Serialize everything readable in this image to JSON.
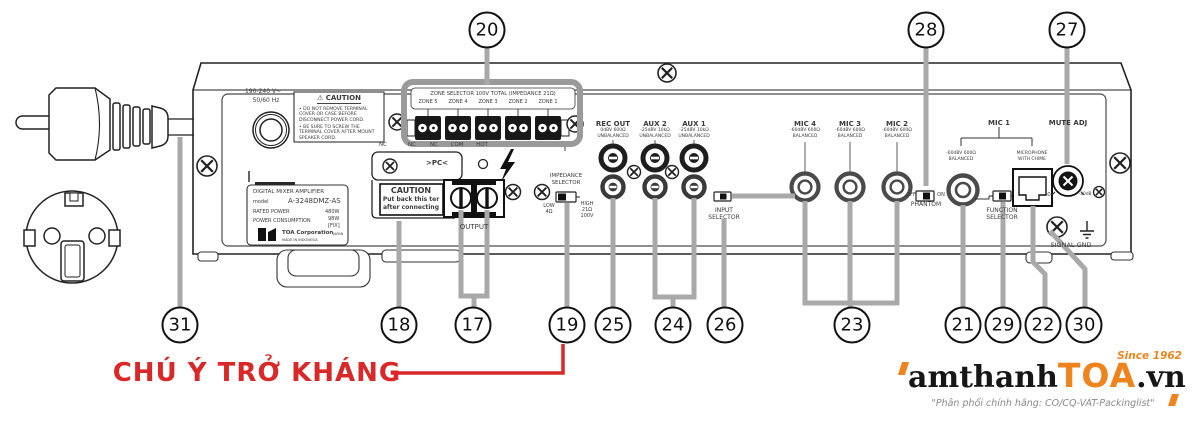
{
  "colors": {
    "accent_red": "#da2727",
    "logo_orange": "#f0841c",
    "leader_gray": "#a9a9a9"
  },
  "warning_text": "CHÚ Ý TRỞ KHÁNG",
  "callouts": {
    "top": [
      "20",
      "28",
      "27"
    ],
    "bottom": [
      "31",
      "18",
      "17",
      "19",
      "25",
      "24",
      "26",
      "23",
      "21",
      "29",
      "22",
      "30"
    ]
  },
  "logo": {
    "brand_black": "amthanh",
    "brand_orange": "TOA",
    "brand_suffix": ".vn",
    "since": "Since 1962",
    "tagline": "\"Phân phối chính hãng: CO/CQ-VAT-Packinglist\""
  },
  "panel": {
    "power": {
      "rating": "190-240 V~",
      "freq": "50/60 Hz"
    },
    "caution_box": {
      "title": "⚠ CAUTION",
      "item1": "• DO NOT REMOVE TERMINAL COVER OR CASE BEFORE DISCONNECT POWER CORD.",
      "item2": "• BE SURE TO SCREW THE TERMINAL COVER AFTER MOUNT SPEAKER CORD."
    },
    "model_label": {
      "type": "DIGITAL MIXER AMPLIFIER",
      "model_key": "model",
      "model_value": "A-3248DMZ-AS",
      "rated_key": "RATED POWER",
      "rated_value": "480W",
      "cons_key": "POWER CONSUMPTION",
      "cons_value": "98W",
      "cons_value2": "[FIX]",
      "corp": "TOA Corporation",
      "corp_region": "JAPAN",
      "made": "MADE IN INDONESIA"
    },
    "zone": {
      "title": "ZONE SELECTOR 100V TOTAL (IMPEDANCE 21Ω)",
      "zones": [
        "ZONE 5",
        "ZONE 4",
        "ZONE 3",
        "ZONE 2",
        "ZONE 1"
      ]
    },
    "terminals": {
      "labels": [
        "NC",
        "NC",
        "NC",
        "COM",
        "HOT"
      ]
    },
    "pc_flap": {
      "label": ">PC<",
      "caution_title": "CAUTION",
      "caution_l1": "Put back this ter",
      "caution_l2": "after connecting"
    },
    "output": {
      "label": "OUTPUT"
    },
    "impedance": {
      "t1": "IMPEDANCE",
      "t2": "SELECTOR",
      "low1": "LOW",
      "low2": "4Ω",
      "high1": "HIGH",
      "high2": "21Ω",
      "high3": "100V"
    },
    "rec_out": {
      "name": "REC OUT",
      "spec1": "0dBV 600Ω",
      "spec2": "UNBALANCED"
    },
    "aux2": {
      "name": "AUX 2",
      "spec1": "-25dBV 10kΩ",
      "spec2": "UNBALANCED"
    },
    "aux1": {
      "name": "AUX 1",
      "spec1": "-25dBV 10kΩ",
      "spec2": "UNBALANCED"
    },
    "input_selector": {
      "l1": "INPUT",
      "l2": "SELECTOR"
    },
    "mic4": {
      "name": "MIC 4",
      "spec1": "-60dBV 600Ω",
      "spec2": "BALANCED"
    },
    "mic3": {
      "name": "MIC 3",
      "spec1": "-60dBV 600Ω",
      "spec2": "BALANCED"
    },
    "mic2": {
      "name": "MIC 2",
      "spec1": "-60dBV 600Ω",
      "spec2": "BALANCED"
    },
    "mic1": {
      "name": "MIC 1",
      "xlr1": "-60dBV 600Ω",
      "xlr2": "BALANCED",
      "rj1": "MICROPHONE",
      "rj2": "WITH CHIME"
    },
    "phantom": {
      "off": "OFF",
      "on": "ON",
      "label": "PHANTOM"
    },
    "function_selector": {
      "l1": "FUNCTION",
      "l2": "SELECTOR"
    },
    "mute": {
      "label": "MUTE ADJ",
      "min": "0",
      "max": "-30dB"
    },
    "signal_gnd": {
      "label": "SIGNAL   GND"
    }
  }
}
